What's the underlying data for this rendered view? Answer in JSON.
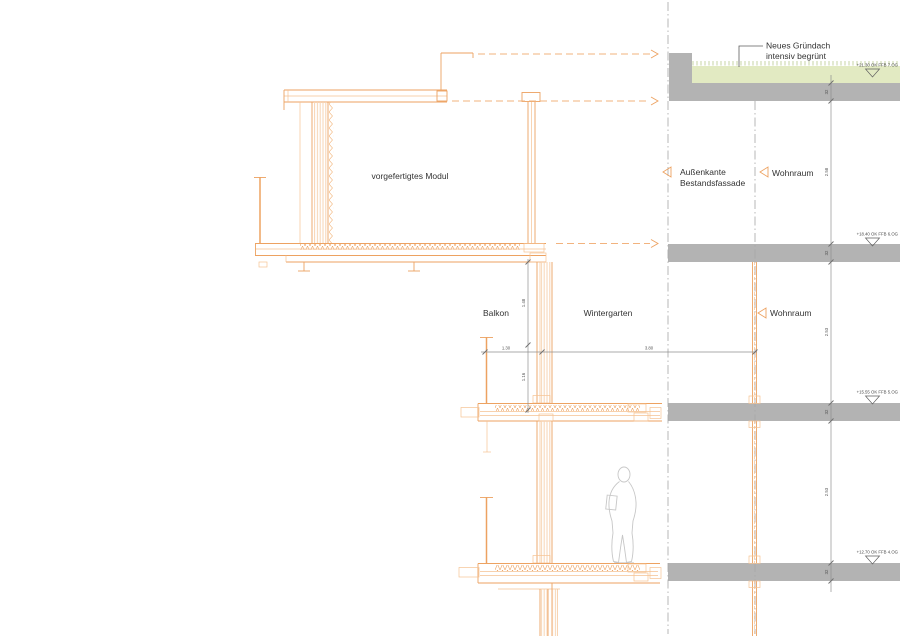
{
  "labels": {
    "module": "vorgefertigtes Modul",
    "aussenkante_line1": "Außenkante",
    "aussenkante_line2": "Bestandsfassade",
    "wohnraum_upper": "Wohnraum",
    "balkon": "Balkon",
    "wintergarten": "Wintergarten",
    "wohnraum_middle": "Wohnraum",
    "gruendach_line1": "Neues Gründach",
    "gruendach_line2": "intensiv begrünt"
  },
  "levels": [
    {
      "text": "+21.30 OK FFB 7.OG"
    },
    {
      "text": "+18.40 OK FFB 6.OG"
    },
    {
      "text": "+15.55 OK FFB 5.OG"
    },
    {
      "text": "+12.70 OK FFB 4.OG"
    }
  ],
  "dims": {
    "balcony_width": "1.30",
    "wintergarten_width": "3.80",
    "upper_height": "1.48",
    "railing_height": "1.16",
    "clear_heights": [
      "2.58",
      "2.53",
      "2.53"
    ],
    "slab_zone": "32"
  },
  "colors": {
    "line_orange": "#eda261",
    "line_orange_light": "#f5c293",
    "hatch_orange": "#f7d4b2",
    "concrete_gray": "#b3b3b3",
    "roof_green": "#e2eac2",
    "grass_green": "#b9c98e",
    "reference_gray": "#a6a6a6",
    "text_dark": "#333333"
  }
}
